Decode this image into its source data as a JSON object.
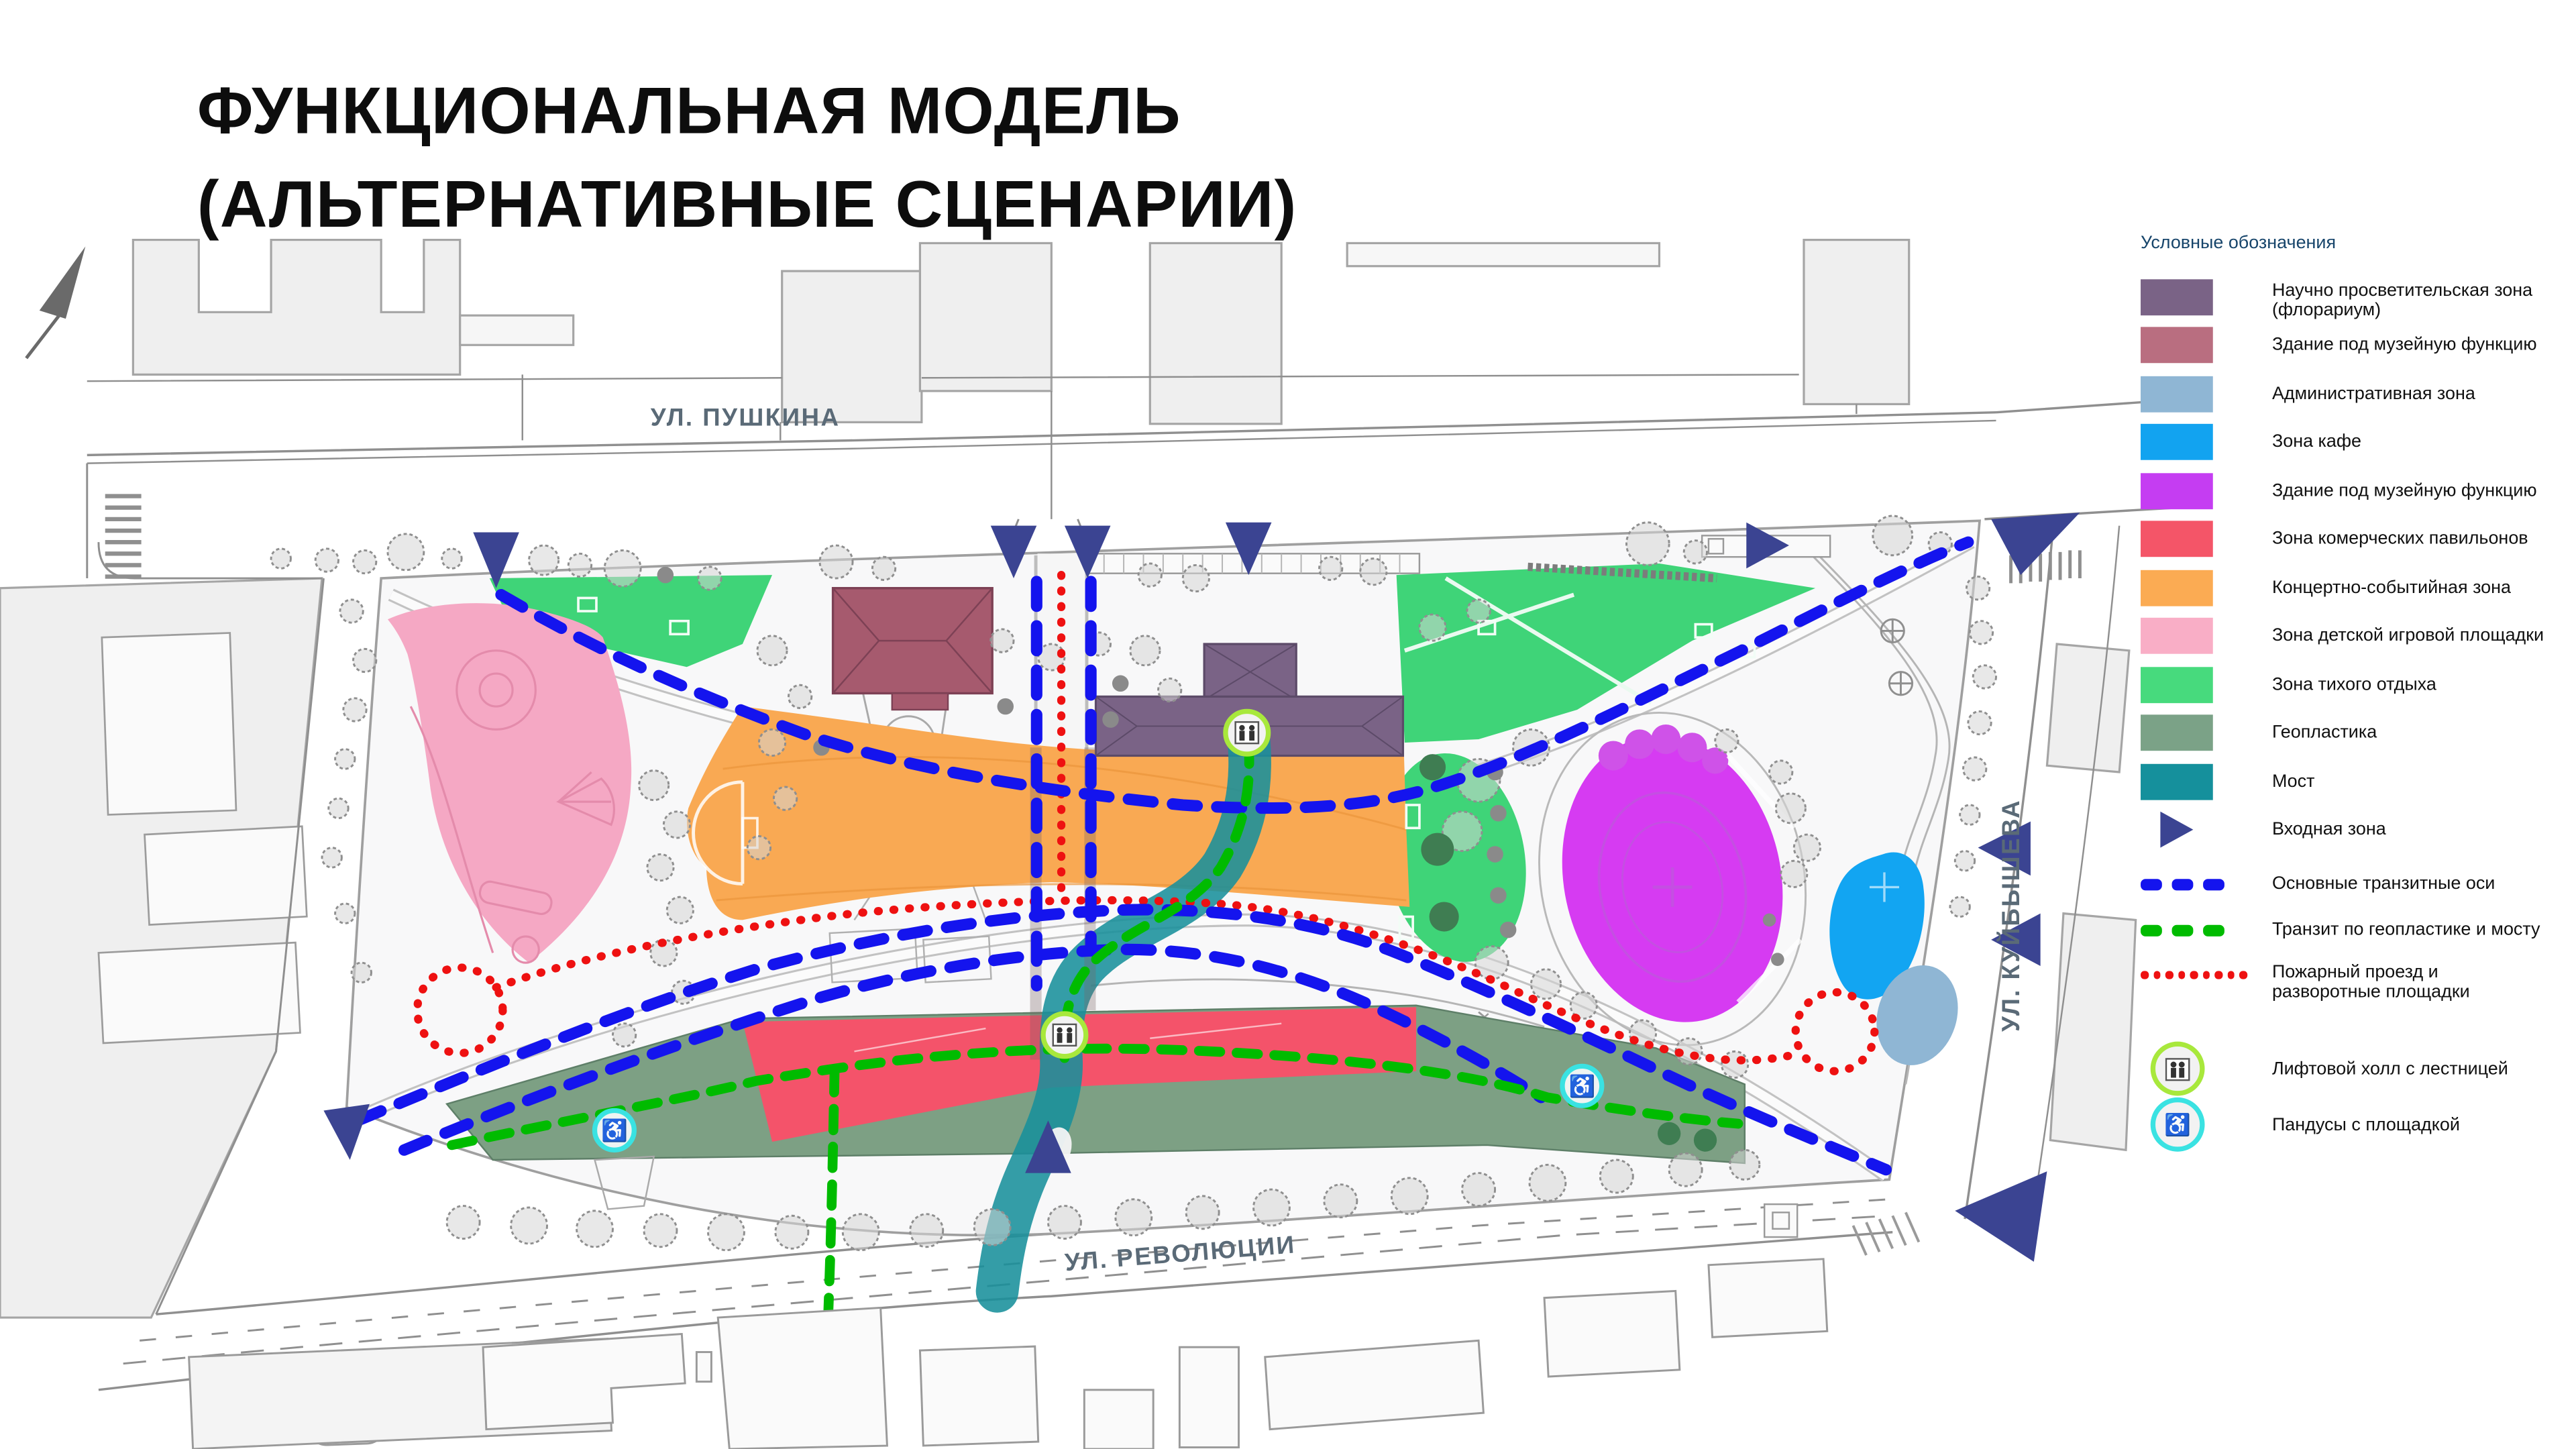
{
  "title": {
    "line1": "ФУНКЦИОНАЛЬНАЯ МОДЕЛЬ",
    "line2": "(АЛЬТЕРНАТИВНЫЕ СЦЕНАРИИ)"
  },
  "streets": {
    "pushkina": "УЛ. ПУШКИНА",
    "revolyutsii": "УЛ. РЕВОЛЮЦИИ",
    "kuibysheva": "УЛ. КУЙБЫШЕВА"
  },
  "legend": {
    "header": "Условные обозначения",
    "items": [
      {
        "type": "swatch",
        "label": "Научно просветительская зона (флорариум)",
        "color": "#7a6386"
      },
      {
        "type": "swatch",
        "label": "Здание под музейную функцию",
        "color": "#b96e80"
      },
      {
        "type": "swatch",
        "label": "Административная зона",
        "color": "#8fb6d4"
      },
      {
        "type": "swatch",
        "label": "Зона кафе",
        "color": "#12a3f0"
      },
      {
        "type": "swatch",
        "label": "Здание под музейную функцию",
        "color": "#c53df2"
      },
      {
        "type": "swatch",
        "label": "Зона комерческих павильонов",
        "color": "#f45568"
      },
      {
        "type": "swatch",
        "label": "Концертно-событийная зона",
        "color": "#fbab53"
      },
      {
        "type": "swatch",
        "label": "Зона детской игровой площадки",
        "color": "#f9aec6"
      },
      {
        "type": "swatch",
        "label": "Зона тихого отдыха",
        "color": "#47da7d"
      },
      {
        "type": "swatch",
        "label": "Геопластика",
        "color": "#7ba287"
      },
      {
        "type": "swatch",
        "label": "Мост",
        "color": "#15909c"
      },
      {
        "type": "triangle",
        "label": "Входная зона",
        "color": "#3b4492"
      },
      {
        "type": "dash",
        "label": "Основные транзитные оси",
        "color": "#1414ee"
      },
      {
        "type": "dash",
        "label": "Транзит по геопластике и мосту",
        "color": "#00bb00"
      },
      {
        "type": "dots",
        "label": "Пожарный проезд и разворотные площадки",
        "color": "#ee1111"
      },
      {
        "type": "icon-elevator",
        "label": "Лифтовой холл с лестницей",
        "color": "#a8e83c"
      },
      {
        "type": "icon-ramp",
        "label": "Пандусы с площадкой",
        "color": "#3ae2e2"
      }
    ]
  }
}
